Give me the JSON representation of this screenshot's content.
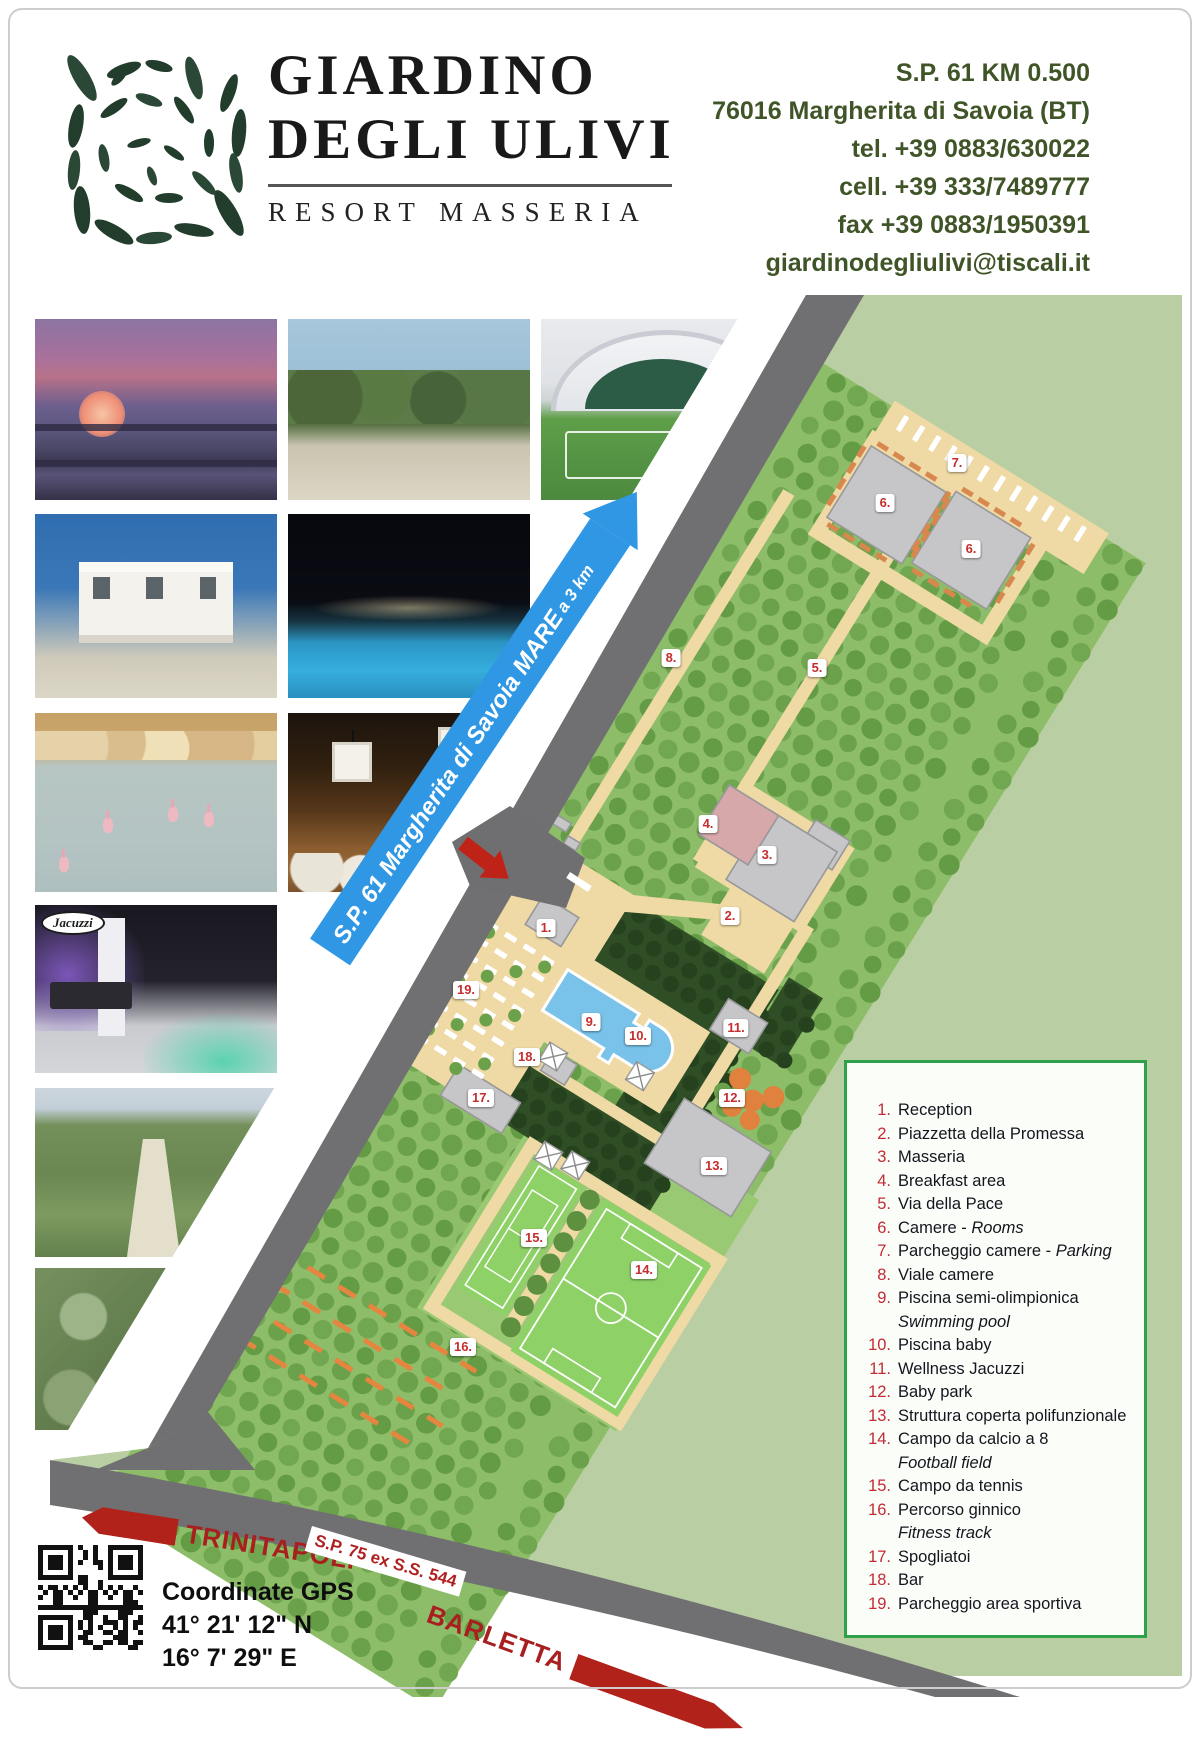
{
  "header": {
    "brand_line1": "GIARDINO",
    "brand_line2": "DEGLI ULIVI",
    "brand_sub": "RESORT MASSERIA",
    "contact": {
      "address_line1": "S.P. 61 KM 0.500",
      "address_line2": "76016 Margherita di Savoia (BT)",
      "tel": "tel.  +39 0883/630022",
      "cell": "cell. +39 333/7489777",
      "fax": "fax +39 0883/1950391",
      "email": "giardinodegliulivi@tiscali.it"
    }
  },
  "photos": [
    {
      "id": "sunset-salt-pans"
    },
    {
      "id": "garden-terrace"
    },
    {
      "id": "indoor-soccer-field"
    },
    {
      "id": "white-villa"
    },
    {
      "id": "night-pool"
    },
    {
      "id": "flamingos"
    },
    {
      "id": "night-restaurant-terrace"
    },
    {
      "id": "wellness-jacuzzi",
      "logo_text": "Jacuzzi"
    },
    {
      "id": "garden-aerial"
    },
    {
      "id": "olive-trees"
    }
  ],
  "map": {
    "road_banner": {
      "text": "S.P. 61 Margherita di Savoia MARE",
      "suffix": "a 3 km"
    },
    "bottom_road_label": "S.P. 75 ex S.S. 544",
    "direction_left": "TRINITAPOLI",
    "direction_right": "BARLETTA",
    "markers": [
      {
        "label": "1.",
        "x": 546,
        "y": 928
      },
      {
        "label": "2.",
        "x": 730,
        "y": 916
      },
      {
        "label": "3.",
        "x": 767,
        "y": 855
      },
      {
        "label": "4.",
        "x": 708,
        "y": 824
      },
      {
        "label": "5.",
        "x": 817,
        "y": 668
      },
      {
        "label": "6.",
        "x": 885,
        "y": 503
      },
      {
        "label": "6.",
        "x": 971,
        "y": 549
      },
      {
        "label": "7.",
        "x": 957,
        "y": 463
      },
      {
        "label": "8.",
        "x": 671,
        "y": 658
      },
      {
        "label": "9.",
        "x": 591,
        "y": 1022
      },
      {
        "label": "10.",
        "x": 638,
        "y": 1036
      },
      {
        "label": "11.",
        "x": 736,
        "y": 1028
      },
      {
        "label": "12.",
        "x": 732,
        "y": 1098
      },
      {
        "label": "13.",
        "x": 714,
        "y": 1166
      },
      {
        "label": "14.",
        "x": 644,
        "y": 1270
      },
      {
        "label": "15.",
        "x": 534,
        "y": 1238
      },
      {
        "label": "16.",
        "x": 463,
        "y": 1347
      },
      {
        "label": "17.",
        "x": 481,
        "y": 1098
      },
      {
        "label": "18.",
        "x": 527,
        "y": 1057
      },
      {
        "label": "19.",
        "x": 466,
        "y": 990
      }
    ]
  },
  "legend": {
    "items": [
      {
        "num": "1.",
        "text": "Reception"
      },
      {
        "num": "2.",
        "text": "Piazzetta della Promessa"
      },
      {
        "num": "3.",
        "text": "Masseria"
      },
      {
        "num": "4.",
        "text": "Breakfast area"
      },
      {
        "num": "5.",
        "text": "Via della Pace"
      },
      {
        "num": "6.",
        "text": "Camere - ",
        "italic": "Rooms"
      },
      {
        "num": "7.",
        "text": "Parcheggio camere - ",
        "italic": "Parking"
      },
      {
        "num": "8.",
        "text": "Viale camere"
      },
      {
        "num": "9.",
        "text": "Piscina semi-olimpionica",
        "sub": "Swimming pool"
      },
      {
        "num": "10.",
        "text": "Piscina baby"
      },
      {
        "num": "11.",
        "text": "Wellness Jacuzzi"
      },
      {
        "num": "12.",
        "text": "Baby park"
      },
      {
        "num": "13.",
        "text": "Struttura coperta polifunzionale"
      },
      {
        "num": "14.",
        "text": "Campo da calcio a 8",
        "sub": "Football field"
      },
      {
        "num": "15.",
        "text": "Campo da tennis"
      },
      {
        "num": "16.",
        "text": "Percorso ginnico",
        "sub": "Fitness track"
      },
      {
        "num": "17.",
        "text": "Spogliatoi"
      },
      {
        "num": "18.",
        "text": "Bar"
      },
      {
        "num": "19.",
        "text": "Parcheggio area sportiva"
      }
    ]
  },
  "footer": {
    "gps_title": "Coordinate GPS",
    "gps_lat": "41° 21' 12\" N",
    "gps_lon": "16° 7' 29\" E"
  },
  "colors": {
    "contact_green": "#3f5427",
    "sage": "#b9cea2",
    "property_green": "#8dbd68",
    "tree_green": "#6ba14a",
    "path_tan": "#efd9a4",
    "road_gray": "#707072",
    "banner_blue": "#2f97e3",
    "pool_blue": "#79c2e9",
    "field_green": "#8ed167",
    "marker_red": "#c42e2e",
    "legend_border_green": "#2fa14b",
    "arrow_red": "#b1221b"
  }
}
